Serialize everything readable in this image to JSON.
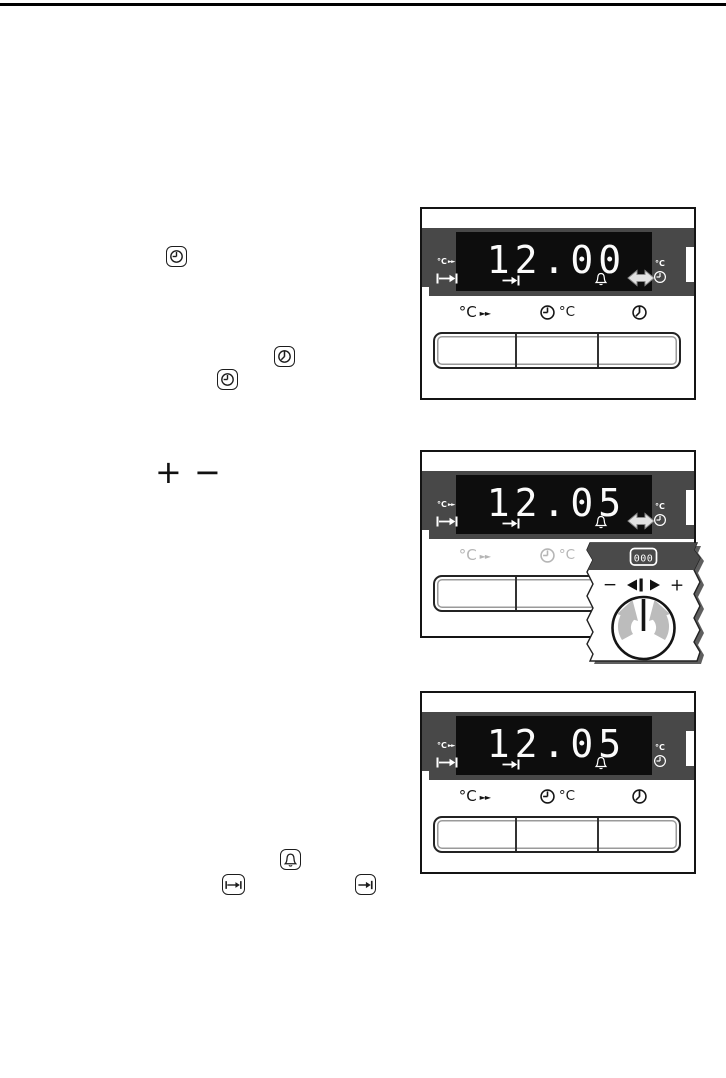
{
  "panels": [
    {
      "time": "12.00"
    },
    {
      "time": "12.05"
    },
    {
      "time": "12.05"
    }
  ],
  "labels": {
    "deg_c": "°C",
    "fast_arrows": "►►"
  },
  "inline": {
    "plus": "+",
    "minus": "−"
  },
  "knob_inset": {
    "display_symbol": "000",
    "minus": "−",
    "plus": "+"
  }
}
